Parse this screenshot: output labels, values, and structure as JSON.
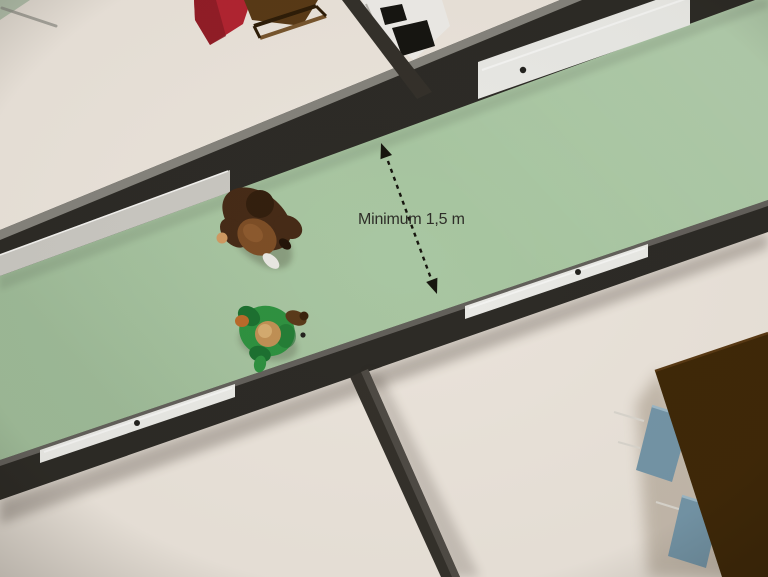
{
  "annotation": {
    "label": "Minimum 1,5 m",
    "color": "#2e2e28",
    "arrow": "#17160f"
  },
  "colors": {
    "room_floor": "#eae3da",
    "corner_green": "#b7c5b0",
    "corner_line": "#8d8d86",
    "corridor_floor": "#a8c6a1",
    "wall_dark": "#2d2b26",
    "wall_top_face": "#8f8d86",
    "rail_light": "#c9c7c1",
    "door_white": "#e9e9e5",
    "door_handle": "#23221e",
    "divider_wall": "#34312b",
    "divider_wall_edge": "#55504a",
    "red_table": "#b22431",
    "red_table_shade": "#8c1c26",
    "wood_table": "#593a16",
    "wood_rail_light": "#77552e",
    "wood_rail_dark": "#2e1d08",
    "stove_body": "#edebe7",
    "stove_burner": "#161511",
    "dining_table": "#3f2808",
    "dining_table_edge": "#5a3a14",
    "chair_blue": "#7495a7",
    "chair_highlight": "#9db8c6",
    "chair_leg": "#d9d5cd",
    "person1_jacket": "#462b17",
    "person1_back": "#7d4e26",
    "person1_back_hi": "#936032",
    "person1_hair": "#331f0e",
    "person1_boot": "#241509",
    "skin": "#cf9a62",
    "shoe": "#e9e7e2",
    "person2_shirt": "#2f9140",
    "person2_shirt_dark": "#1d7030",
    "person2_sleeve": "#5a3a1a",
    "person2_glove": "#3a240e",
    "person2_hand": "#b96a2a",
    "person2_head": "#c09055",
    "person2_head_hi": "#d8b176"
  }
}
